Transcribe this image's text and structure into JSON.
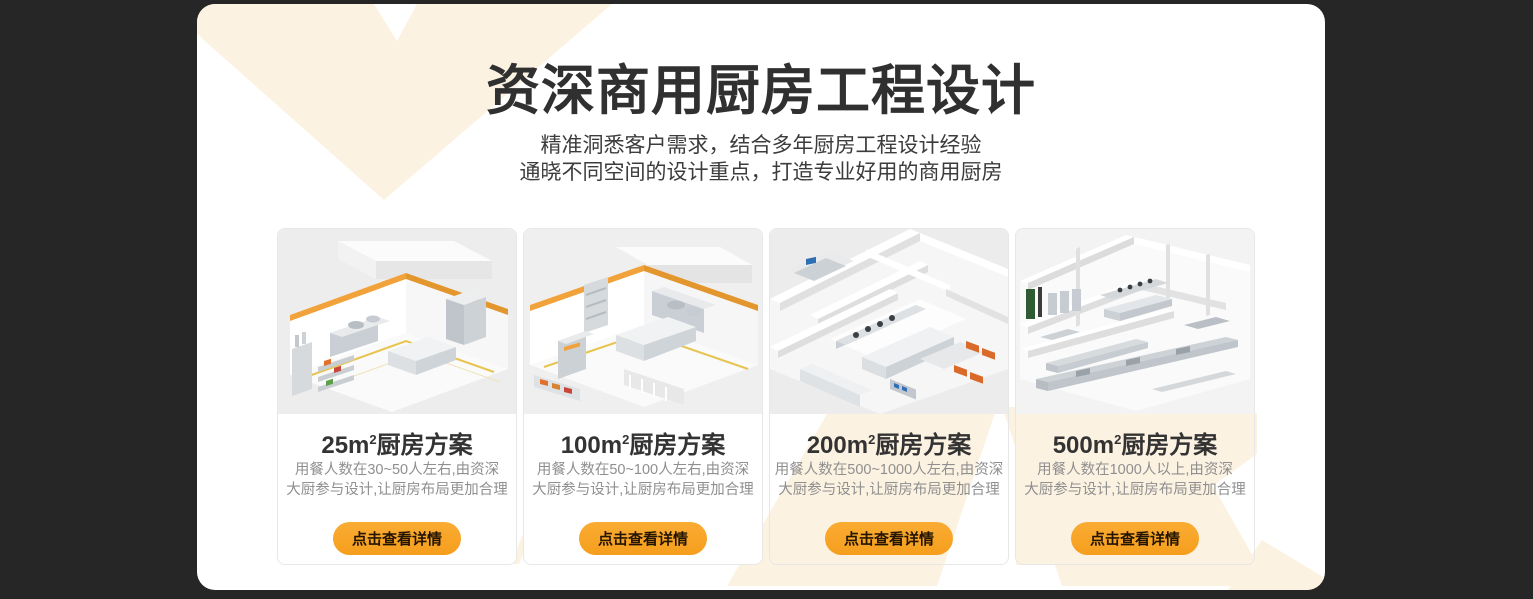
{
  "colors": {
    "page_background": "#262626",
    "panel_background": "#ffffff",
    "decor_cream": "#FCF2E2",
    "accent_orange": "#F9A52B",
    "button_text": "#241503",
    "title_color": "#303030",
    "description_color": "#8f8f8f"
  },
  "header": {
    "title": "资深商用厨房工程设计",
    "subtitle_line1": "精准洞悉客户需求，结合多年厨房工程设计经验",
    "subtitle_line2": "通晓不同空间的设计重点，打造专业好用的商用厨房"
  },
  "cards": [
    {
      "area": "25m",
      "sup": "2",
      "suffix": "厨房方案",
      "image_name": "kitchen-render-25m2",
      "desc1": "用餐人数在30~50人左右,由资深",
      "desc2": "大厨参与设计,让厨房布局更加合理",
      "button_label": "点击查看详情"
    },
    {
      "area": "100m",
      "sup": "2",
      "suffix": "厨房方案",
      "image_name": "kitchen-render-100m2",
      "desc1": "用餐人数在50~100人左右,由资深",
      "desc2": "大厨参与设计,让厨房布局更加合理",
      "button_label": "点击查看详情"
    },
    {
      "area": "200m",
      "sup": "2",
      "suffix": "厨房方案",
      "image_name": "kitchen-render-200m2",
      "desc1": "用餐人数在500~1000人左右,由资深",
      "desc2": "大厨参与设计,让厨房布局更加合理",
      "button_label": "点击查看详情"
    },
    {
      "area": "500m",
      "sup": "2",
      "suffix": "厨房方案",
      "image_name": "kitchen-render-500m2",
      "desc1": "用餐人数在1000人以上,由资深",
      "desc2": "大厨参与设计,让厨房布局更加合理",
      "button_label": "点击查看详情"
    }
  ]
}
